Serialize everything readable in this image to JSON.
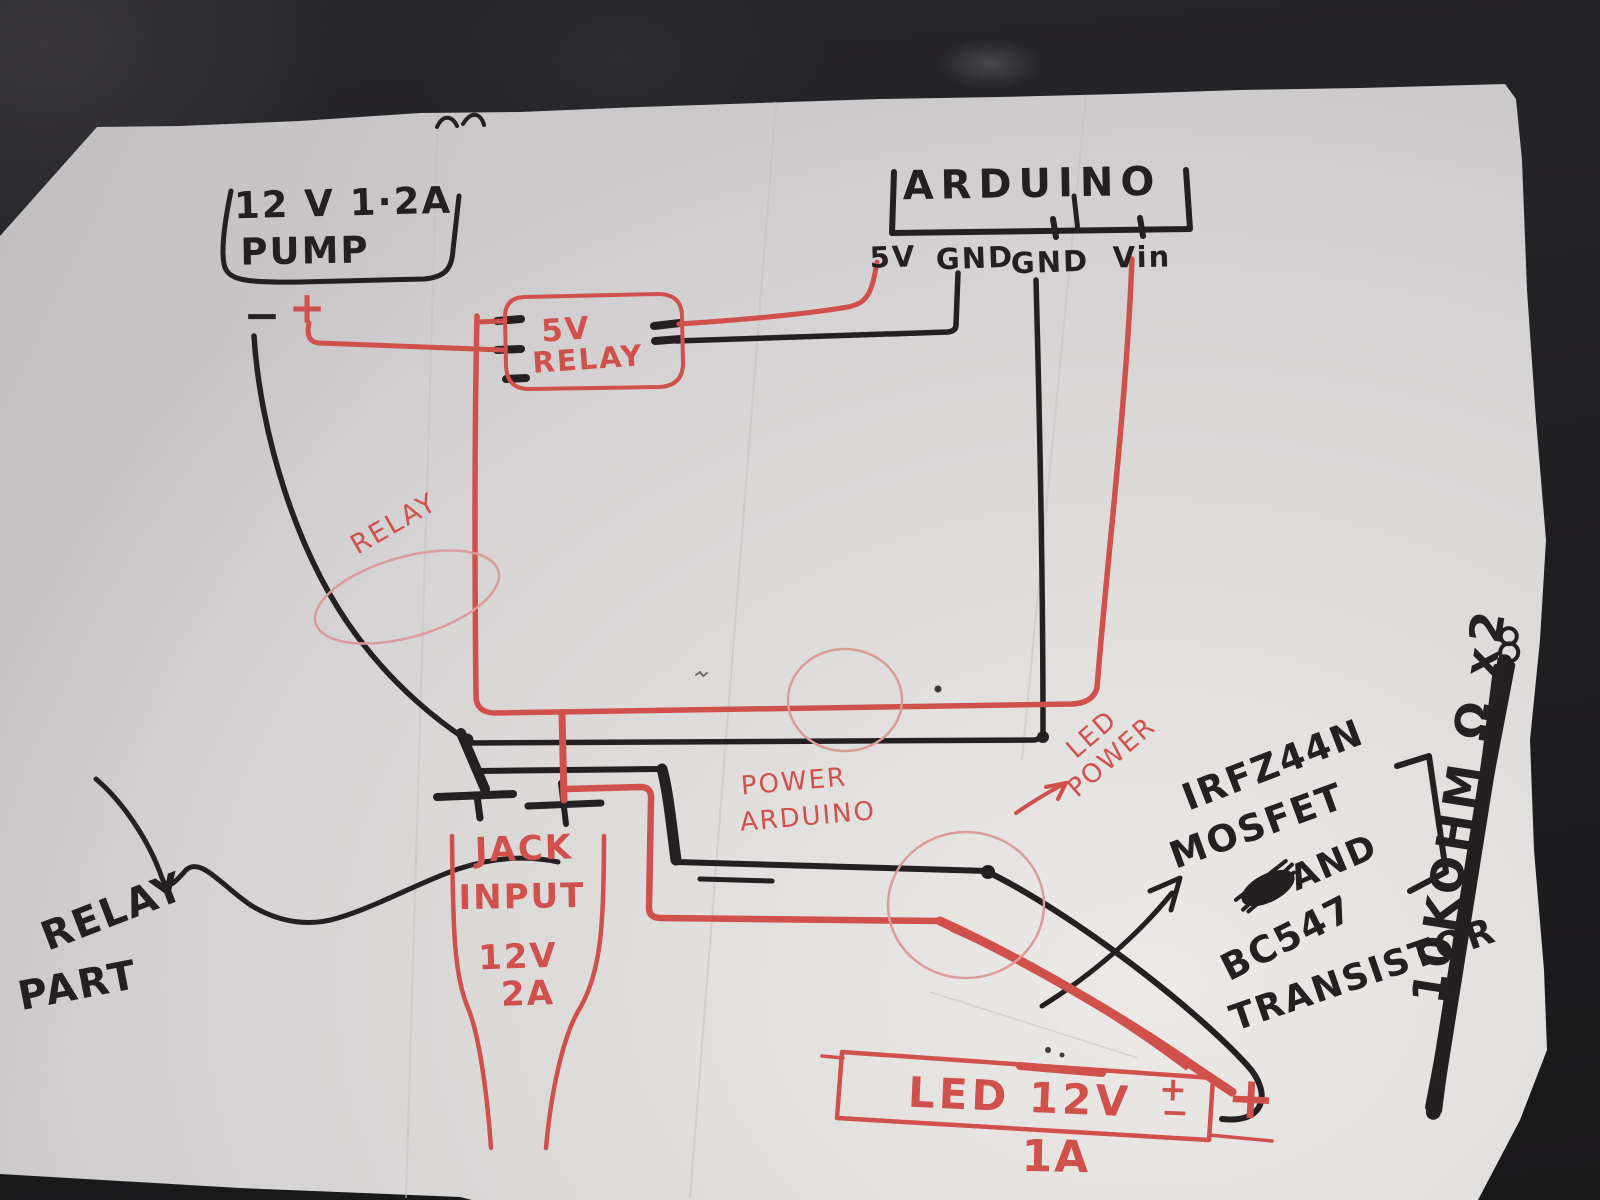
{
  "scene": {
    "ink_black": "#241f20",
    "ink_red": "#d0504c",
    "ink_red_light": "#dd9b97",
    "paper_color": "#dcdad8",
    "background_color": "#222125",
    "description": "Hand-drawn wiring diagram on torn paper: Arduino, 5V relay, 12V pump, jack input, LED strip, MOSFET/transistor notes"
  },
  "labels": {
    "pump": {
      "line1": "12 V 1·2A",
      "line2": "PUMP",
      "minus": "−",
      "plus": "+"
    },
    "arduino": {
      "title": "ARDUINO",
      "pins": [
        "5V",
        "GND",
        "GND",
        "Vin"
      ]
    },
    "relay": {
      "line1": "5V",
      "line2": "RELAY"
    },
    "relay_note": "RELAY",
    "jack": {
      "line1": "JACK",
      "line2": "INPUT",
      "line3": "12V",
      "line4": "2A"
    },
    "power_arduino": {
      "line1": "POWER",
      "line2": "ARDUINO"
    },
    "led_power": {
      "line1": "LED",
      "line2": "POWER"
    },
    "mosfet_note": {
      "line1": "IRFZ44N",
      "line2": "MOSFET",
      "line3": "AND",
      "line4": "BC547",
      "line5": "TRANSISTOR"
    },
    "resistor_note": "10KOHM Ω x2",
    "relay_part": {
      "line1": "RELAY",
      "line2": "PART"
    },
    "led": {
      "name": "LED 12V",
      "current": "1A",
      "plus": "+",
      "minus": "−",
      "big_plus": "+"
    }
  }
}
